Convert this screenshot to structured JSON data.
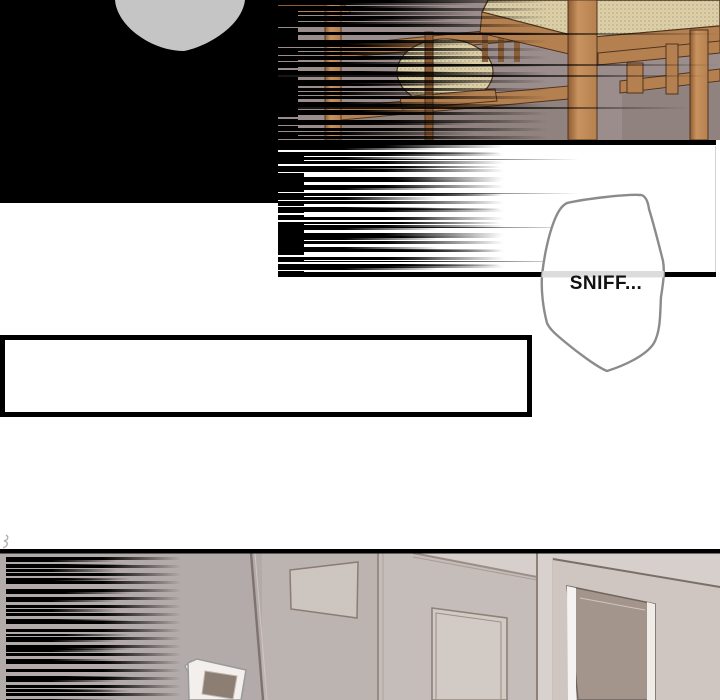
{
  "bubble": {
    "text": "SNIFF..."
  },
  "colors": {
    "ink": "#000000",
    "paper": "#ffffff",
    "text": "#121212",
    "silhouette": "#c5c5c5",
    "p1_wall": "#9b8d8b",
    "p1_wall_dark": "#90837f",
    "wood": "#b5804f",
    "wood_light": "#c8935e",
    "wood_dark": "#8f5c33",
    "wood_outline": "#50341f",
    "cushion": "#ddd0a9",
    "cushion_dot": "#a99b75",
    "cushion_shadow": "#c9bb93",
    "bubble_outline": "#8b8b8b",
    "bubble_band": "#dcdcdc",
    "r_wall_left": "#b3aba9",
    "r_wall_mid": "#bcb4b0",
    "r_wall_c": "#c5bdb9",
    "r_wall_light": "#d7cfcb",
    "r_line": "#8d8178",
    "edge_dark": "#7e736e",
    "door_face": "#cfc6c1",
    "door_dark": "#a3958c",
    "door_outline": "#6f645e",
    "white_hl": "#f5f3f1",
    "inset_fill": "#d2cac5",
    "frame_fill": "#cdc5c0",
    "frame_line": "#8a7c75",
    "kiosk_body": "#f2efec",
    "kiosk_screen": "#8d7e74",
    "kiosk_line": "#9a9a9a"
  }
}
